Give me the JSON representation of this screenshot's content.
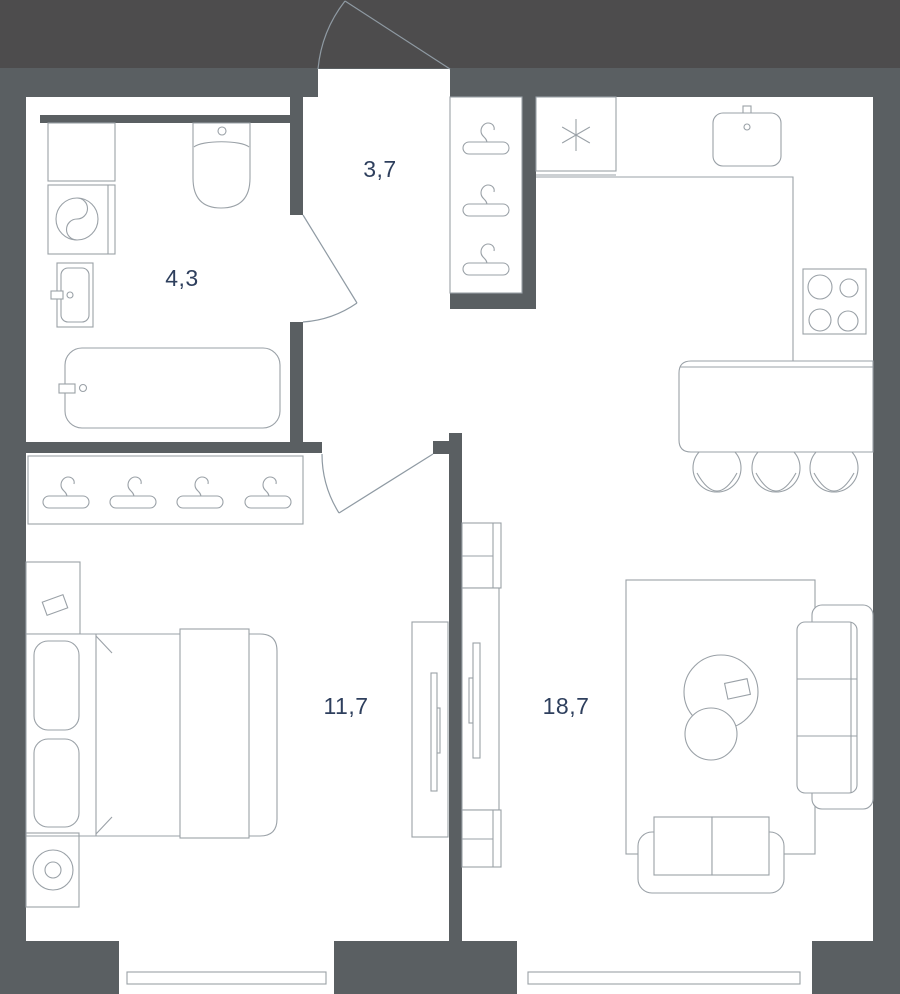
{
  "floorplan": {
    "rooms": {
      "hallway": {
        "area": "3,7"
      },
      "bathroom": {
        "area": "4,3"
      },
      "bedroom": {
        "area": "11,7"
      },
      "living_kitchen": {
        "area": "18,7"
      }
    },
    "colors": {
      "outside_bg": "#4d4c4d",
      "wall": "#5a5f62",
      "floor": "#ffffff",
      "fixture_outline": "#9aa1a7",
      "area_label_text": "#2e3f5d",
      "door_swing": "#8f9aa3"
    }
  }
}
